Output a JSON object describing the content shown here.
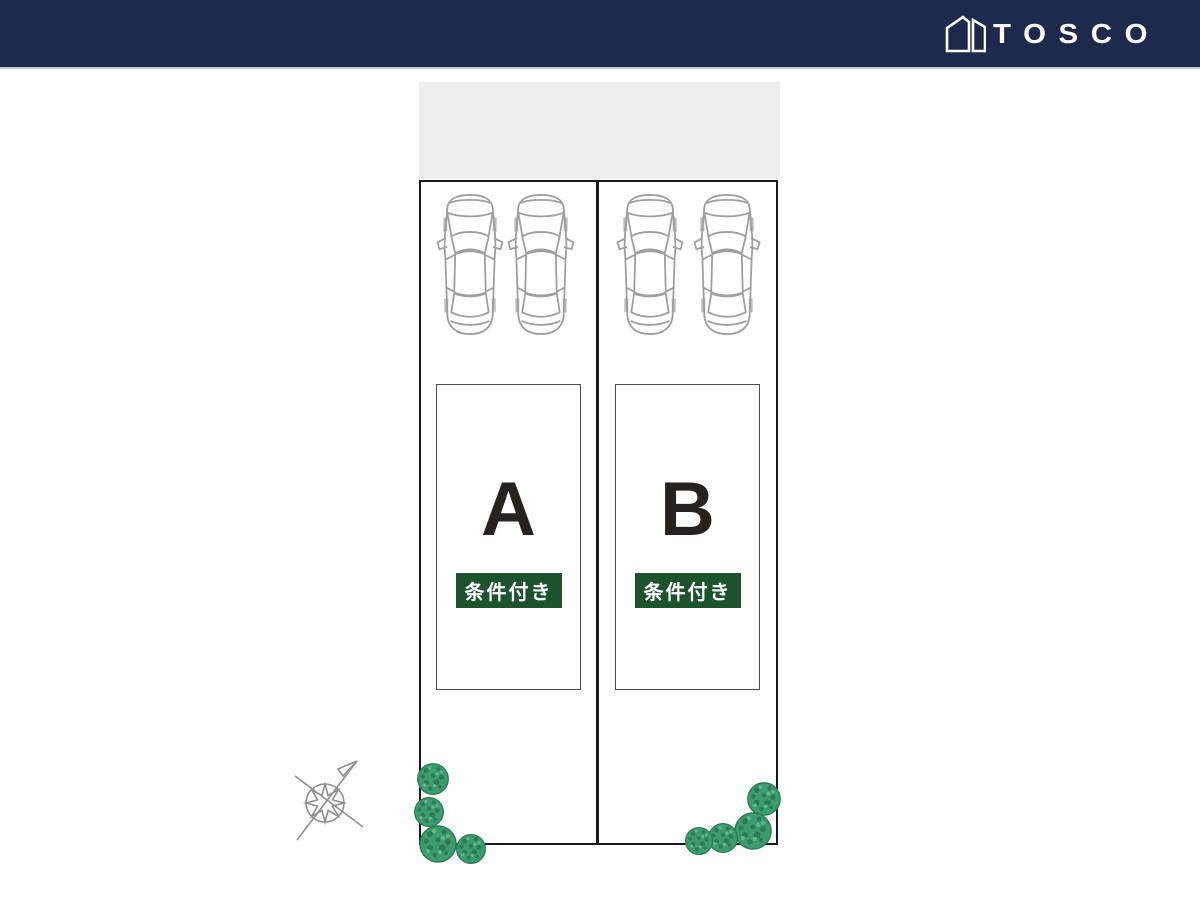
{
  "header": {
    "brand": "TOSCO",
    "background_color": "#1e2a4c",
    "logo_color": "#ffffff"
  },
  "site_plan": {
    "road_color": "#eeeeee",
    "outline_color": "#1a1a1a",
    "footprint_border_color": "#4d4d4d",
    "letter_color": "#262220",
    "car_outline_color": "#9e9e9e",
    "tree_color": "#3d9c6d",
    "compass_color": "#8f8f8f",
    "cars_per_lot": 2,
    "lots": [
      {
        "id": "A",
        "label": "A",
        "badge": "条件付き",
        "badge_bg": "#1c522e",
        "badge_fg": "#ffffff"
      },
      {
        "id": "B",
        "label": "B",
        "badge": "条件付き",
        "badge_bg": "#1c522e",
        "badge_fg": "#ffffff"
      }
    ],
    "icons": {
      "logo": "tosco-house-logo-icon",
      "car": "car-top-view-icon",
      "tree": "tree-icon",
      "compass": "north-arrow-icon"
    }
  }
}
